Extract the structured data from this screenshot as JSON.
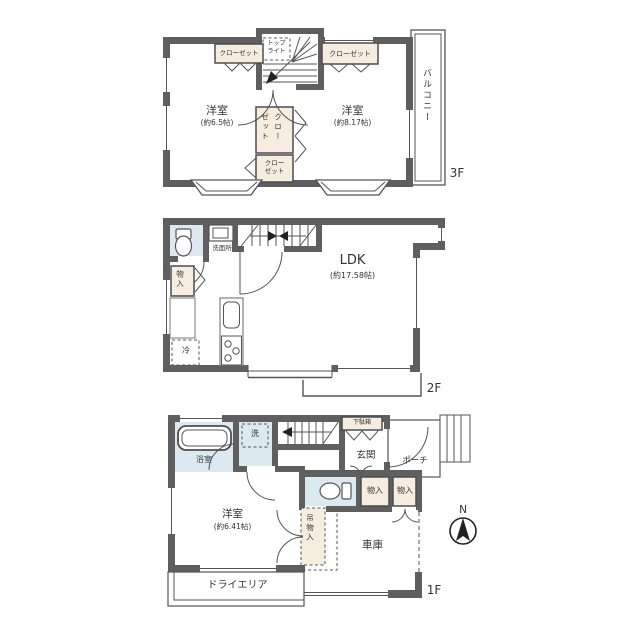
{
  "palette": {
    "wall": "#5f5f5f",
    "closet_fill": "#f6ecdf",
    "wet_area_fill": "#dce9f1",
    "line": "#555555",
    "text": "#333333"
  },
  "f3": {
    "floor_label": "3F",
    "room_left_name": "洋室",
    "room_left_size": "(約6.5帖)",
    "room_right_name": "洋室",
    "room_right_size": "(約8.17帖)",
    "closet_top_left": "クローゼット",
    "closet_top_right": "クローゼット",
    "closet_mid_col_right": "クロー",
    "closet_mid_col_left": "ゼット",
    "closet_bottom_line1": "クロー",
    "closet_bottom_line2": "ゼット",
    "skylight_line1": "トップ",
    "skylight_line2": "ライト",
    "balcony": "バルコニー"
  },
  "f2": {
    "floor_label": "2F",
    "ldk_name": "LDK",
    "ldk_size": "(約17.58帖)",
    "washroom": "洗面所",
    "storage": "物入",
    "fridge": "冷"
  },
  "f1": {
    "floor_label": "1F",
    "bathroom": "浴室",
    "washer": "洗",
    "entrance": "玄関",
    "shoe_cabinet": "下駄箱",
    "porch": "ポーチ",
    "storage_a": "物入",
    "storage_b": "物入",
    "room_name": "洋室",
    "room_size": "(約6.41帖)",
    "hanging_storage": "吊物入",
    "garage": "車庫",
    "dry_area": "ドライエリア"
  },
  "compass": {
    "north_label": "N"
  }
}
